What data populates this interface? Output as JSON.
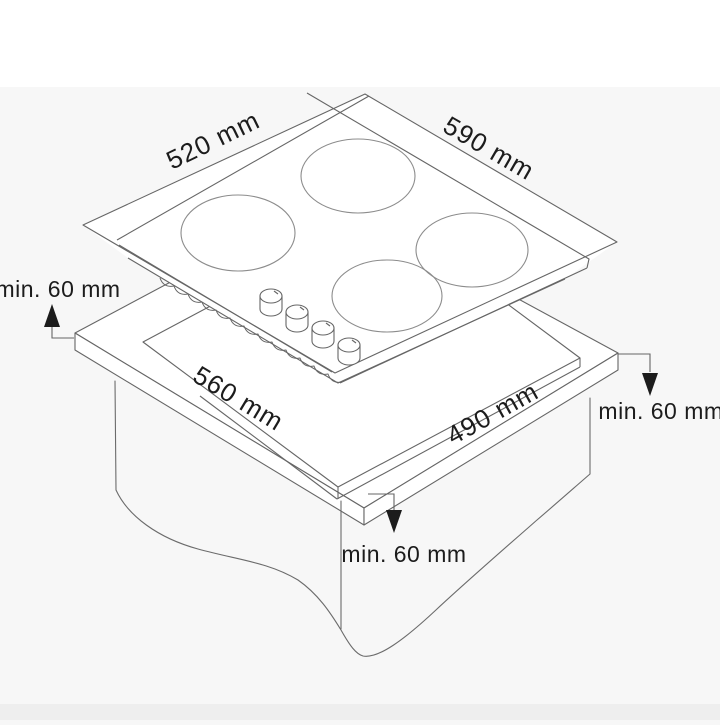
{
  "diagram": {
    "type": "hob-installation-dimensions",
    "labels": {
      "hob_depth": "520 mm",
      "hob_width": "590 mm",
      "cutout_width": "560 mm",
      "cutout_depth": "490 mm",
      "clearance_left": "min. 60 mm",
      "clearance_right": "min. 60 mm",
      "clearance_front": "min. 60 mm"
    },
    "counts": {
      "burners": "4",
      "control_knobs": "4"
    },
    "colors": {
      "line": "#666666",
      "burner_line": "#8c8c8c",
      "text": "#1c1c1c",
      "background": "#f7f7f7"
    }
  }
}
